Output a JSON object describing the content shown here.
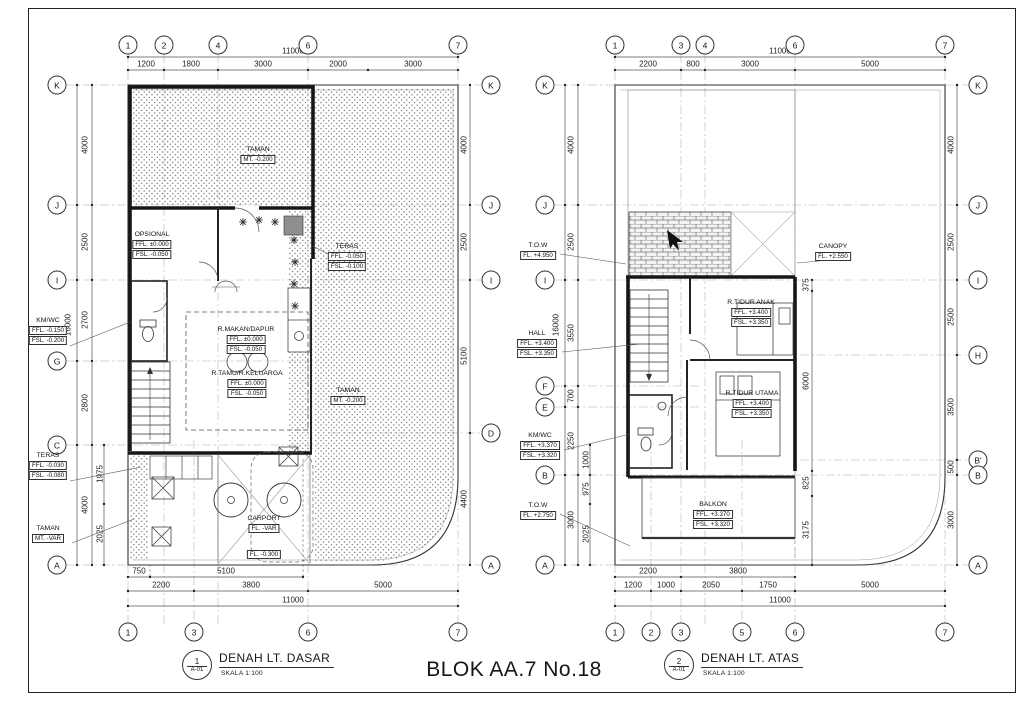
{
  "doc_title": "BLOK AA.7 No.18",
  "p1": {
    "sheet_num": "1",
    "sheet_ref": "A-01",
    "title": "DENAH LT. DASAR",
    "scale": "SKALA 1:100",
    "top_bubbles": [
      "1",
      "2",
      "4",
      "6",
      "7"
    ],
    "bottom_bubbles": [
      "1",
      "3",
      "6",
      "7"
    ],
    "left_bubbles": [
      "K",
      "J",
      "I",
      "G",
      "C",
      "A"
    ],
    "right_bubbles": [
      "K",
      "J",
      "I",
      "D",
      "A"
    ],
    "top_total": "11000",
    "top_segs": [
      "1200",
      "1800",
      "3000",
      "2000",
      "3000"
    ],
    "bottom_total": "11000",
    "bottom_segs": [
      "2200",
      "3800",
      "5000"
    ],
    "bottom_subs": [
      "750",
      "5100"
    ],
    "left_dims": [
      "4000",
      "2500",
      "2700",
      "2800",
      "4000"
    ],
    "left_total": "16000",
    "left_subs": [
      "1975",
      "2025"
    ],
    "right_dims": [
      "4000",
      "2500",
      "5100",
      "4400"
    ],
    "labels": {
      "taman_top_name": "TAMAN",
      "taman_top_val": "MT.  -0.200",
      "opsional_name": "OPSIONAL",
      "opsional_v1": "FFL. ±0.000",
      "opsional_v2": "FSL. -0.050",
      "teras_r_name": "TERAS",
      "teras_r_v1": "FFL. -0.050",
      "teras_r_v2": "FSL. -0.100",
      "kmwc_name": "KM/WC",
      "kmwc_v1": "FFL. -0.150",
      "kmwc_v2": "FSL. -0.200",
      "rmakan_name": "R.MAKAN/DAPUR",
      "rmakan_v1": "FFL. ±0.000",
      "rmakan_v2": "FSL. -0.050",
      "rtamu_name": "R.TAMU/R.KELUARGA",
      "rtamu_v1": "FFL. ±0.000",
      "rtamu_v2": "FSL. -0.050",
      "taman_r_name": "TAMAN",
      "taman_r_val": "MT.  -0.200",
      "teras_l_name": "TERAS",
      "teras_l_v1": "FFL. -0.030",
      "teras_l_v2": "FSL. -0.080",
      "taman_l_name": "TAMAN",
      "taman_l_val": "MT.  -VAR",
      "carport_name": "CARPORT",
      "carport_v1": "FL.  -VAR",
      "carport_v2": "FL.  -0.300"
    }
  },
  "p2": {
    "sheet_num": "2",
    "sheet_ref": "A-01",
    "title": "DENAH LT. ATAS",
    "scale": "SKALA 1:100",
    "top_bubbles": [
      "1",
      "3",
      "4",
      "6",
      "7"
    ],
    "bottom_bubbles": [
      "1",
      "2",
      "3",
      "5",
      "6",
      "7"
    ],
    "left_bubbles": [
      "K",
      "J",
      "I",
      "F",
      "E",
      "B",
      "A"
    ],
    "right_bubbles": [
      "K",
      "J",
      "I",
      "H",
      "B'",
      "B",
      "A"
    ],
    "top_total": "11000",
    "top_segs": [
      "2200",
      "800",
      "3000",
      "5000"
    ],
    "bottom_total": "11000",
    "bottom_segs": [
      "1200",
      "1000",
      "2050",
      "1750",
      "5000"
    ],
    "bottom_subs": [
      "2200",
      "3800"
    ],
    "left_dims": [
      "4000",
      "2500",
      "3550",
      "700",
      "2250",
      "3000"
    ],
    "left_total": "16000",
    "left_subs": [
      "1000",
      "975",
      "2025"
    ],
    "right_dims": [
      "4000",
      "2500",
      "2500",
      "3500",
      "500",
      "3000"
    ],
    "inner_dims": [
      "375",
      "6000",
      "825",
      "3175"
    ],
    "labels": {
      "tow_top_name": "T.O.W",
      "tow_top_val": "FL.  +4.950",
      "canopy_name": "CANOPY",
      "canopy_val": "FL.  +2.550",
      "hall_name": "HALL",
      "hall_v1": "FFL. +3.400",
      "hall_v2": "FSL. +3.350",
      "anak_name": "R.TIDUR  ANAK",
      "anak_v1": "FFL. +3.400",
      "anak_v2": "FSL. +3.350",
      "utama_name": "R.TIDUR  UTAMA",
      "utama_v1": "FFL. +3.400",
      "utama_v2": "FSL. +3.350",
      "kmwc_name": "KM/WC",
      "kmwc_v1": "FFL. +3.370",
      "kmwc_v2": "FSL. +3.320",
      "balkon_name": "BALKON",
      "balkon_v1": "FFL. +3.370",
      "balkon_v2": "FSL. +3.320",
      "tow_bot_name": "T.O.W",
      "tow_bot_val": "FL.  +2.750"
    }
  }
}
